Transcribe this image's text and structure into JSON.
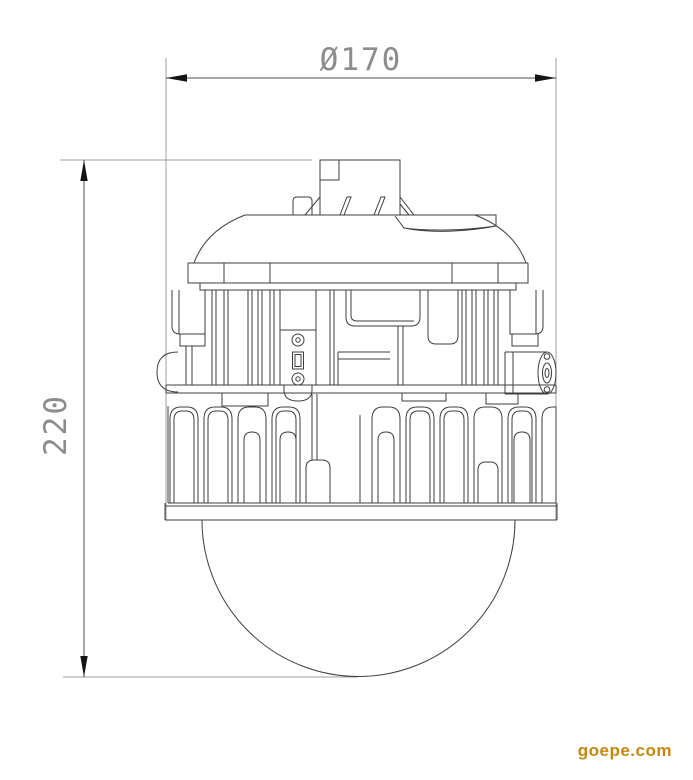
{
  "drawing": {
    "dimension_diameter": "Ø170",
    "dimension_height": "220",
    "line_color": "#3e3e3e",
    "extension_line_color": "#9d9d9d",
    "dimension_text_color": "#8c8c8c"
  },
  "watermark": {
    "text": "goepe.com",
    "color": "#c9860e"
  }
}
